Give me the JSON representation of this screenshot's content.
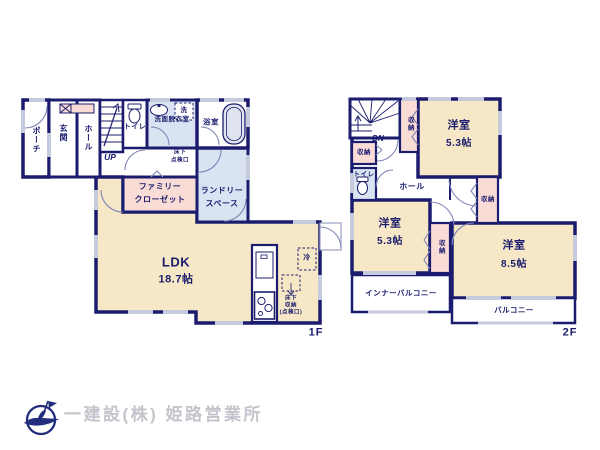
{
  "colors": {
    "wall": "#1b1c6e",
    "room_cream": "#f6e8c6",
    "room_pink": "#f9dcd6",
    "room_blue": "#d9e3f2",
    "window_marking": "#c5cadf",
    "label_text": "#1b1c6e",
    "logo_text_gray": "#c3c4cc"
  },
  "floor1": {
    "label": "1F",
    "porch": "ポーチ",
    "entrance": "玄関",
    "hall": "ホール",
    "stairs_up": "UP",
    "toilet": "トイレ",
    "washroom": "洗面脱衣室",
    "washer": "洗",
    "bath": "浴室",
    "underfloor_hatch_l1": "床下",
    "underfloor_hatch_l2": "点検口",
    "family_closet_l1": "ファミリー",
    "family_closet_l2": "クローゼット",
    "laundry_l1": "ランドリー",
    "laundry_l2": "スペース",
    "ldk": "LDK",
    "ldk_size": "18.7帖",
    "fridge": "冷",
    "underfloor_storage_l1": "床下",
    "underfloor_storage_l2": "収納",
    "underfloor_storage_l3": "(点検口)"
  },
  "floor2": {
    "label": "2F",
    "stairs_down": "DN",
    "storage_a": "収納",
    "toilet": "トイレ",
    "storage_b": "収納",
    "room_53a": "洋室",
    "room_53a_size": "5.3帖",
    "hall": "ホール",
    "room_53b": "洋室",
    "room_53b_size": "5.3帖",
    "storage_c": "収納",
    "storage_d": "収納",
    "room_85": "洋室",
    "room_85_size": "8.5帖",
    "inner_balcony": "インナーバルコニー",
    "balcony": "バルコニー"
  },
  "footer": {
    "company": "一建設(株) 姫路営業所"
  }
}
